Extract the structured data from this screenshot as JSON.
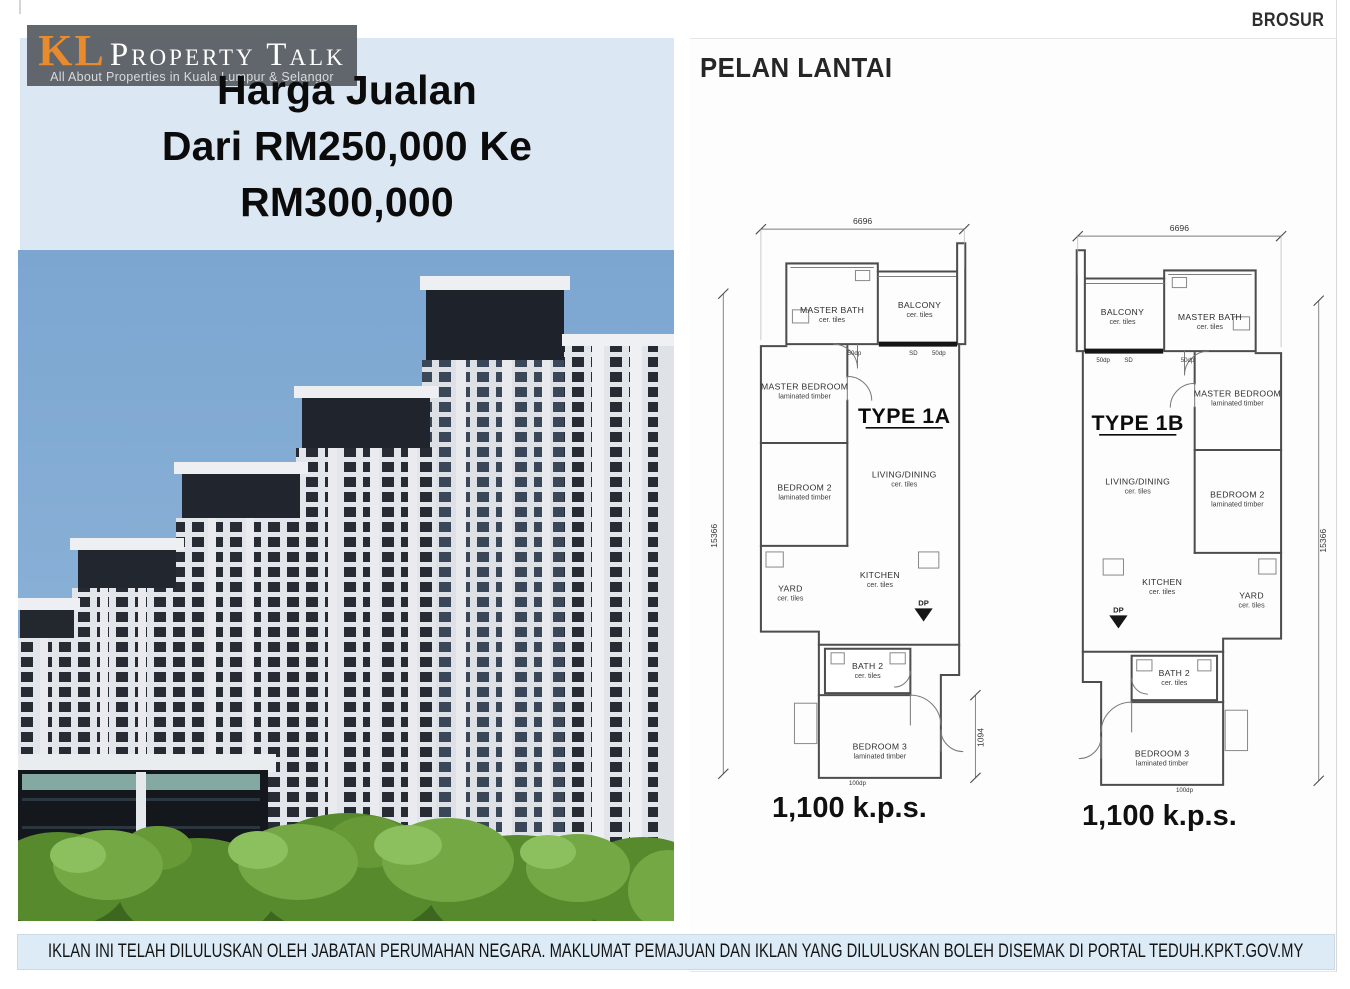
{
  "header": {
    "brosur": "BROSUR"
  },
  "logo": {
    "kl": "KL",
    "name": "Property Talk",
    "tagline": "All About Properties in Kuala Lumpur & Selangor"
  },
  "hero": {
    "line1": "Harga Jualan",
    "line2": "Dari RM250,000 Ke",
    "line3": "RM300,000"
  },
  "floor_plans": {
    "title": "PELAN LANTAI",
    "plans": [
      {
        "type_label": "TYPE 1A",
        "area": "1,100 k.p.s.",
        "dims": {
          "width": "6696",
          "height": "15366",
          "entry": "1094"
        },
        "rooms": {
          "master_bath": {
            "name": "MASTER BATH",
            "finish": "cer. tiles"
          },
          "balcony": {
            "name": "BALCONY",
            "finish": "cer. tiles"
          },
          "master_bedroom": {
            "name": "MASTER BEDROOM",
            "finish": "laminated timber"
          },
          "living": {
            "name": "LIVING/DINING",
            "finish": "cer. tiles"
          },
          "bedroom2": {
            "name": "BEDROOM 2",
            "finish": "laminated timber"
          },
          "yard": {
            "name": "YARD",
            "finish": "cer. tiles"
          },
          "kitchen": {
            "name": "KITCHEN",
            "finish": "cer. tiles"
          },
          "bath2": {
            "name": "BATH 2",
            "finish": "cer. tiles"
          },
          "bedroom3": {
            "name": "BEDROOM 3",
            "finish": "laminated timber"
          }
        },
        "marks": {
          "sd": "SD",
          "dp": "DP",
          "d50": "50dp",
          "d100": "100dp"
        }
      },
      {
        "type_label": "TYPE 1B",
        "area": "1,100 k.p.s.",
        "dims": {
          "width": "6696",
          "height": "15366"
        },
        "rooms": {
          "master_bath": {
            "name": "MASTER BATH",
            "finish": "cer. tiles"
          },
          "balcony": {
            "name": "BALCONY",
            "finish": "cer. tiles"
          },
          "master_bedroom": {
            "name": "MASTER BEDROOM",
            "finish": "laminated timber"
          },
          "living": {
            "name": "LIVING/DINING",
            "finish": "cer. tiles"
          },
          "bedroom2": {
            "name": "BEDROOM 2",
            "finish": "laminated timber"
          },
          "yard": {
            "name": "YARD",
            "finish": "cer. tiles"
          },
          "kitchen": {
            "name": "KITCHEN",
            "finish": "cer. tiles"
          },
          "bath2": {
            "name": "BATH 2",
            "finish": "cer. tiles"
          },
          "bedroom3": {
            "name": "BEDROOM 3",
            "finish": "laminated timber"
          }
        },
        "marks": {
          "sd": "SD",
          "dp": "DP",
          "d50": "50dp",
          "d100": "100dp"
        }
      }
    ]
  },
  "disclaimer": {
    "text": "IKLAN INI TELAH DILULUSKAN OLEH JABATAN PERUMAHAN NEGARA. MAKLUMAT PEMAJUAN DAN IKLAN YANG DILULUSKAN BOLEH DISEMAK DI PORTAL TEDUH.KPKT.GOV.MY"
  },
  "colors": {
    "hero_bg": "#dbe7f2",
    "disclaimer_bg": "#dcebf6",
    "logo_orange": "#e98a2c",
    "sky_top": "#7ca6d0",
    "sky_bottom": "#93b8dc"
  }
}
